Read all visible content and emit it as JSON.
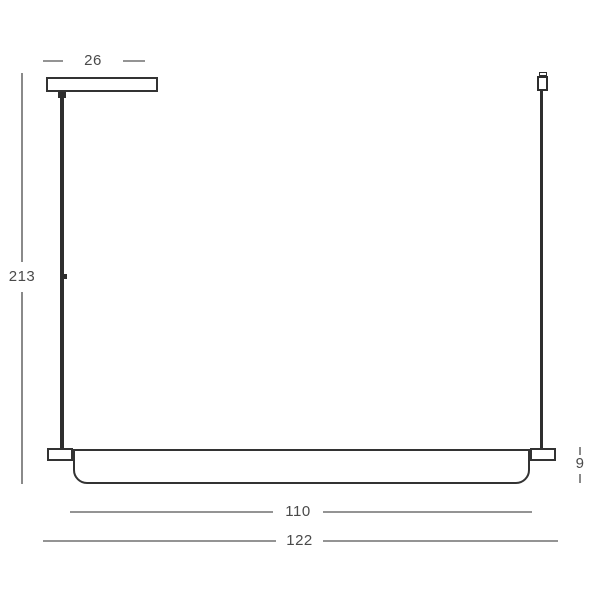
{
  "drawing": {
    "kind": "linear-pendant-lamp-dimension-diagram",
    "dimensions": {
      "canopy_width": "26",
      "suspension_height": "213",
      "fixture_height": "9",
      "inner_length": "110",
      "total_length": "122"
    },
    "colors": {
      "background": "#ffffff",
      "fixture_outline": "#333333",
      "rod_fill": "#2e2e2e",
      "dimension_line": "#949494",
      "label_text": "#4a4a4a"
    }
  }
}
